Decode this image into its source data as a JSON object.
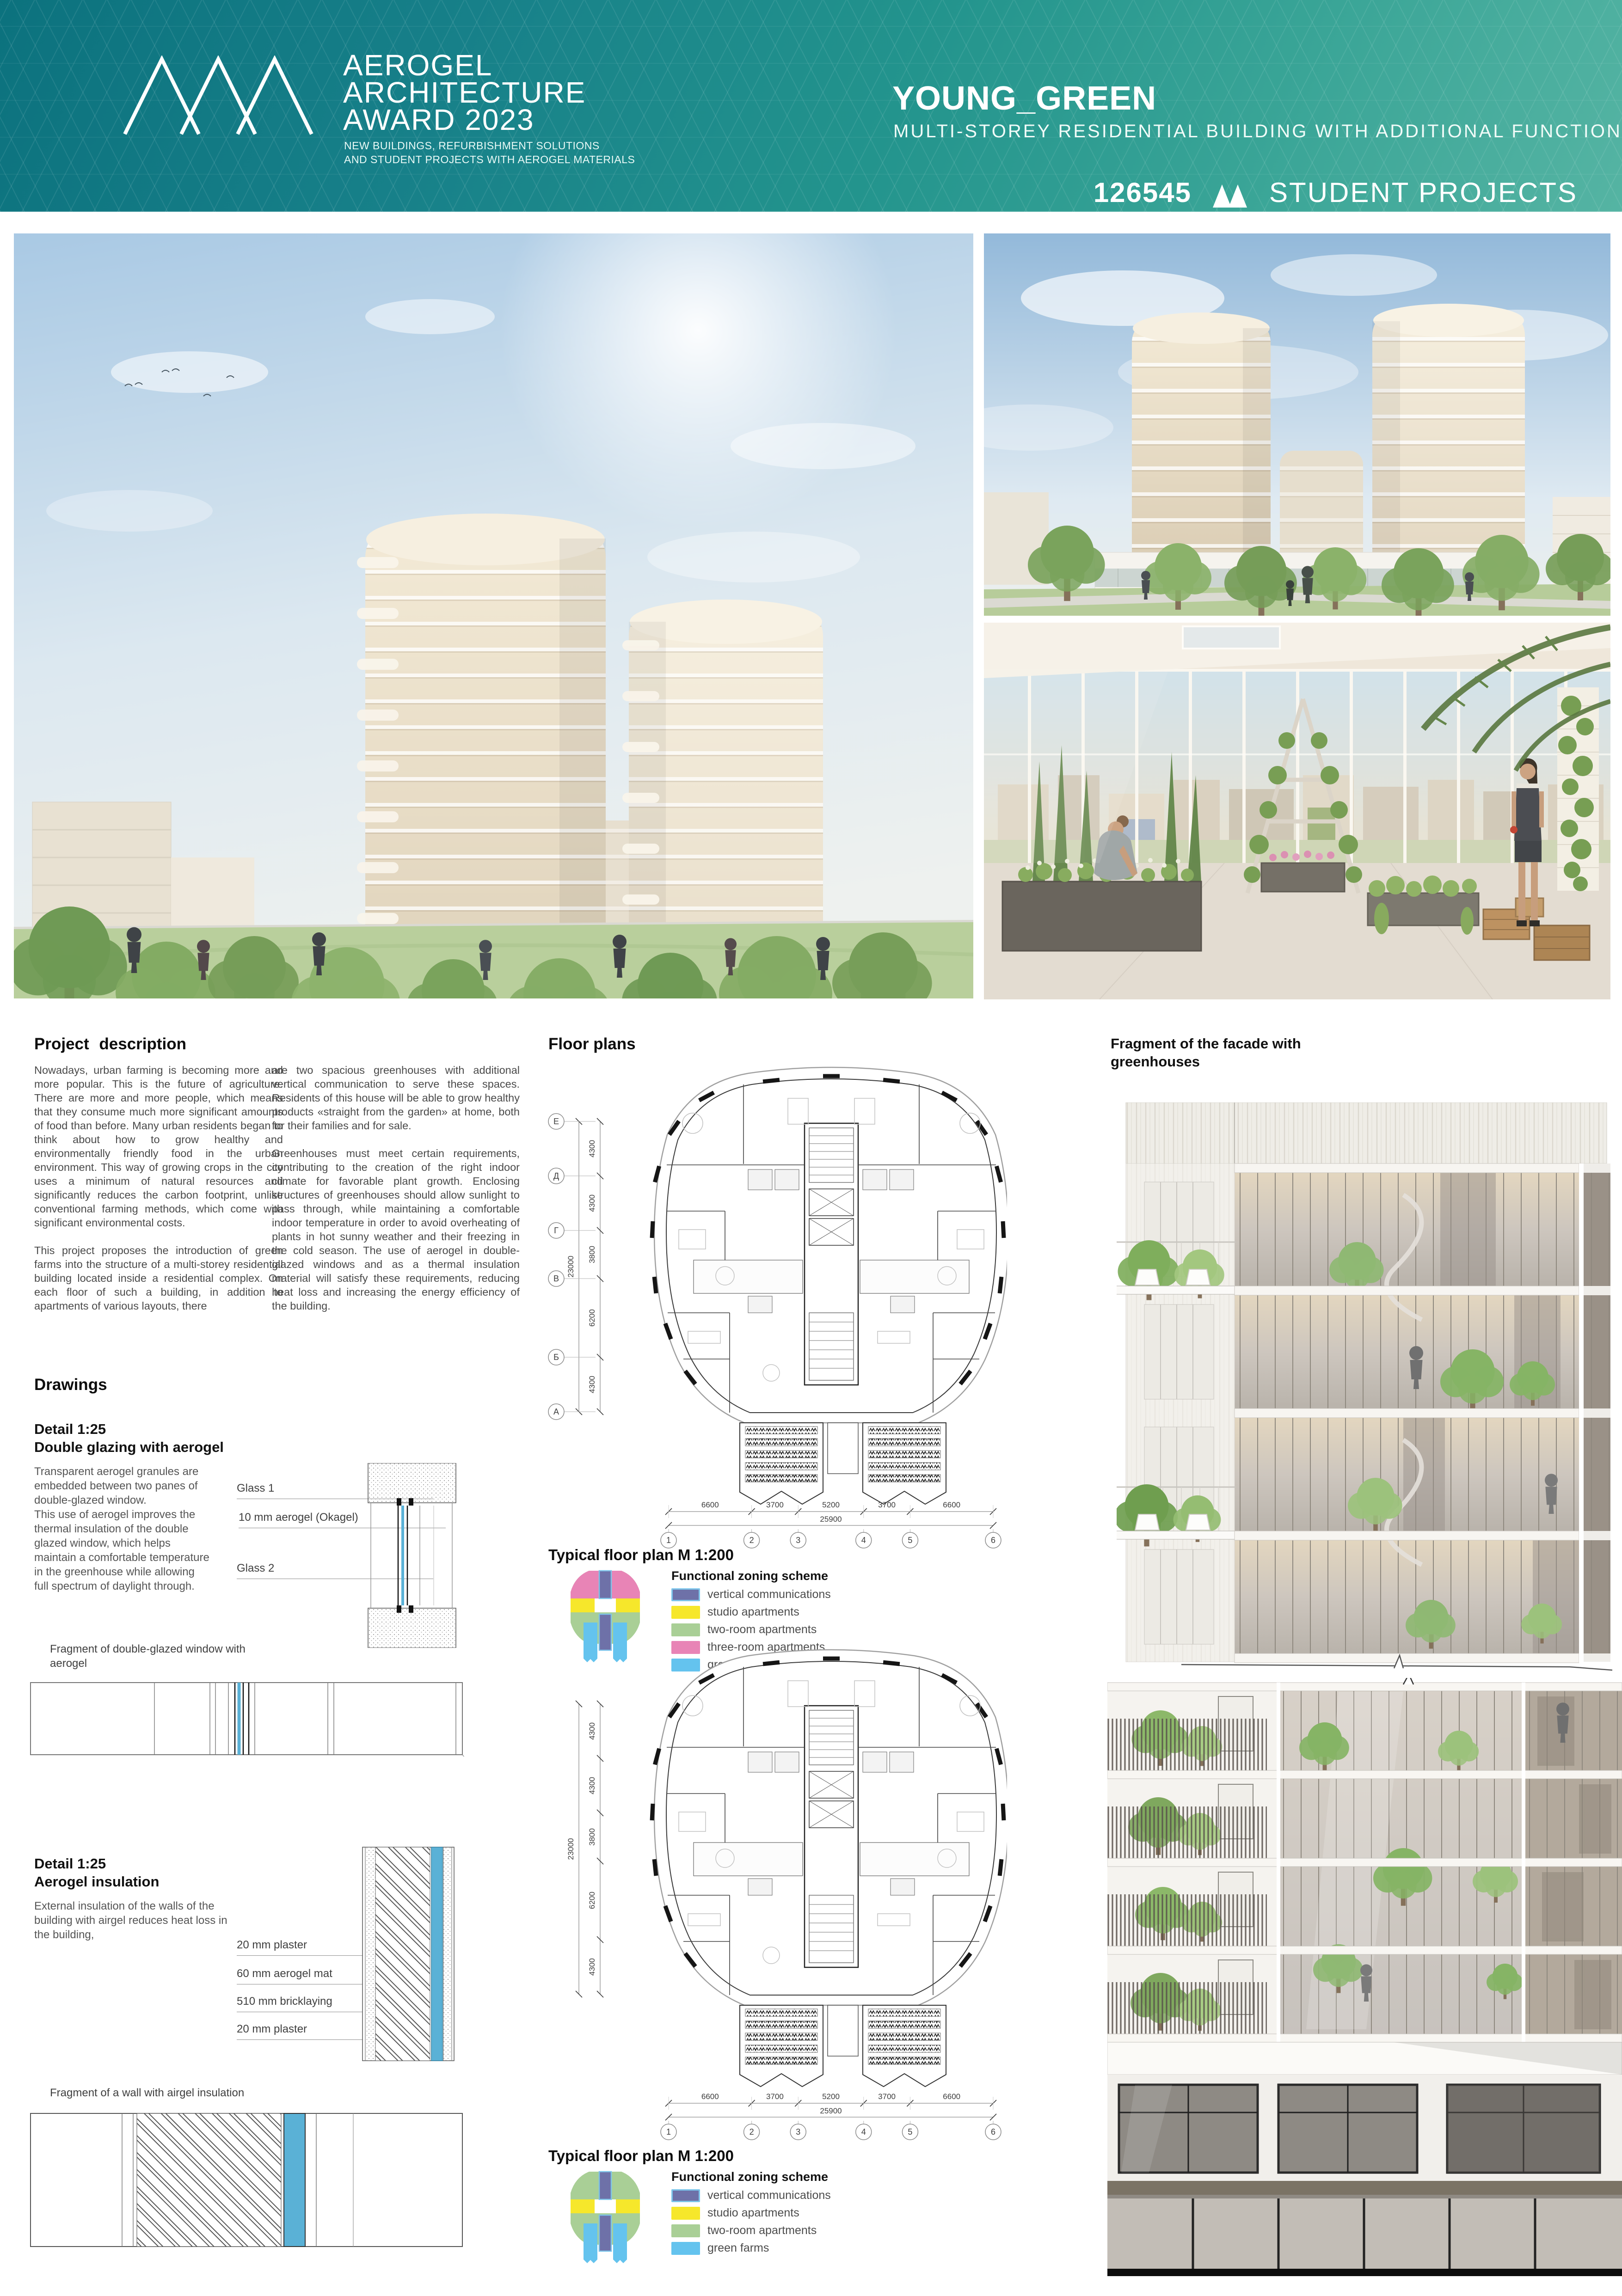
{
  "header": {
    "logo_icon": "mountain-peaks-icon",
    "award_line1": "AEROGEL",
    "award_line2": "ARCHITECTURE",
    "award_line3": "AWARD 2023",
    "award_sub1": "NEW BUILDINGS, REFURBISHMENT SOLUTIONS",
    "award_sub2": "AND STUDENT PROJECTS WITH AEROGEL MATERIALS",
    "project_title": "YOUNG_GREEN",
    "project_subtitle": "MULTI-STOREY RESIDENTIAL BUILDING WITH ADDITIONAL FUNCTION",
    "entry_number": "126545",
    "category_icon": "mountain-icon",
    "category_label": "STUDENT PROJECTS"
  },
  "colors": {
    "teal_dark": "#0c727e",
    "teal_mid": "#23948d",
    "teal_light": "#55b4a3",
    "aerogel_blue": "#5ab1d6"
  },
  "description": {
    "title": "Project description",
    "col1": [
      "Nowadays, urban farming is becoming more and more popular. This is the future of agriculture. There are more and more people, which means that they consume much more significant amounts of food than before. Many urban residents began to think about how to grow healthy and environmentally friendly food in the urban environment. This way of growing crops in the city uses a minimum of natural resources and significantly reduces the carbon footprint, unlike conventional farming methods, which come with significant environmental costs.",
      "This project proposes the introduction of green farms into the structure of a multi-storey residential building located inside a residential complex. On each floor of such a building, in addition to apartments of various layouts, there"
    ],
    "col2": [
      "are two spacious greenhouses with additional vertical communication to serve these spaces. Residents of this house will be able to grow healthy products «straight from the garden» at home, both for their families and for sale.",
      "Greenhouses must meet certain requirements, contributing to the creation of the right indoor climate for favorable plant growth. Enclosing structures of greenhouses should allow sunlight to pass through, while maintaining a comfortable indoor temperature in order to avoid overheating of plants in hot sunny weather and their freezing in the cold season. The use of aerogel in double-glazed windows and as a thermal insulation material will satisfy these requirements, reducing heat loss and increasing the energy efficiency of the building."
    ]
  },
  "floor_plans": {
    "title": "Floor plans",
    "plan_caption": "Typical floor plan M 1:200",
    "legend_title": "Functional zoning scheme",
    "legend1": [
      {
        "label": "vertical communications",
        "color": "#6e71a8",
        "border": "#7cc4ea"
      },
      {
        "label": "studio apartments",
        "color": "#f6e72b"
      },
      {
        "label": "two-room apartments",
        "color": "#a9cf96"
      },
      {
        "label": "three-room apartments",
        "color": "#e884b6"
      },
      {
        "label": "green farms",
        "color": "#64c3ee"
      }
    ],
    "legend2": [
      {
        "label": "vertical communications",
        "color": "#6e71a8",
        "border": "#7cc4ea"
      },
      {
        "label": "studio apartments",
        "color": "#f6e72b"
      },
      {
        "label": "two-room apartments",
        "color": "#a9cf96"
      },
      {
        "label": "green farms",
        "color": "#64c3ee"
      }
    ],
    "grid": {
      "row_letters": [
        "Е",
        "Д",
        "Г",
        "В",
        "Б",
        "А"
      ],
      "row_dims": [
        "4300",
        "4300",
        "3800",
        "6200",
        "4300"
      ],
      "row_total": "23000",
      "col_dims": [
        "6600",
        "3700",
        "5200",
        "3700",
        "6600"
      ],
      "col_total": "25900",
      "col_numbers": [
        "1",
        "2",
        "3",
        "4",
        "5",
        "6"
      ]
    }
  },
  "facade": {
    "title": "Fragment of the facade with greenhouses"
  },
  "drawings": {
    "title": "Drawings",
    "detail_glazing": {
      "caption1": "Detail 1:25",
      "caption2": "Double glazing with aerogel",
      "body": [
        "Transparent aerogel granules are embedded between two panes of double-glazed window.",
        "This use of aerogel improves the thermal insulation of the double glazed window, which helps maintain a comfortable temperature in the greenhouse while allowing full spectrum of daylight through."
      ],
      "labels": [
        "Glass 1",
        "10 mm aerogel (Okagel)",
        "Glass 2"
      ],
      "fragment_caption": "Fragment of double-glazed window with aerogel"
    },
    "detail_insulation": {
      "caption1": "Detail 1:25",
      "caption2": "Aerogel insulation",
      "body": [
        "External insulation of the walls of the building with airgel reduces heat loss in the building,"
      ],
      "labels": [
        "20 mm plaster",
        "60 mm aerogel mat",
        "510 mm bricklaying",
        "20 mm plaster"
      ],
      "fragment_caption": "Fragment of a wall with airgel insulation"
    }
  }
}
